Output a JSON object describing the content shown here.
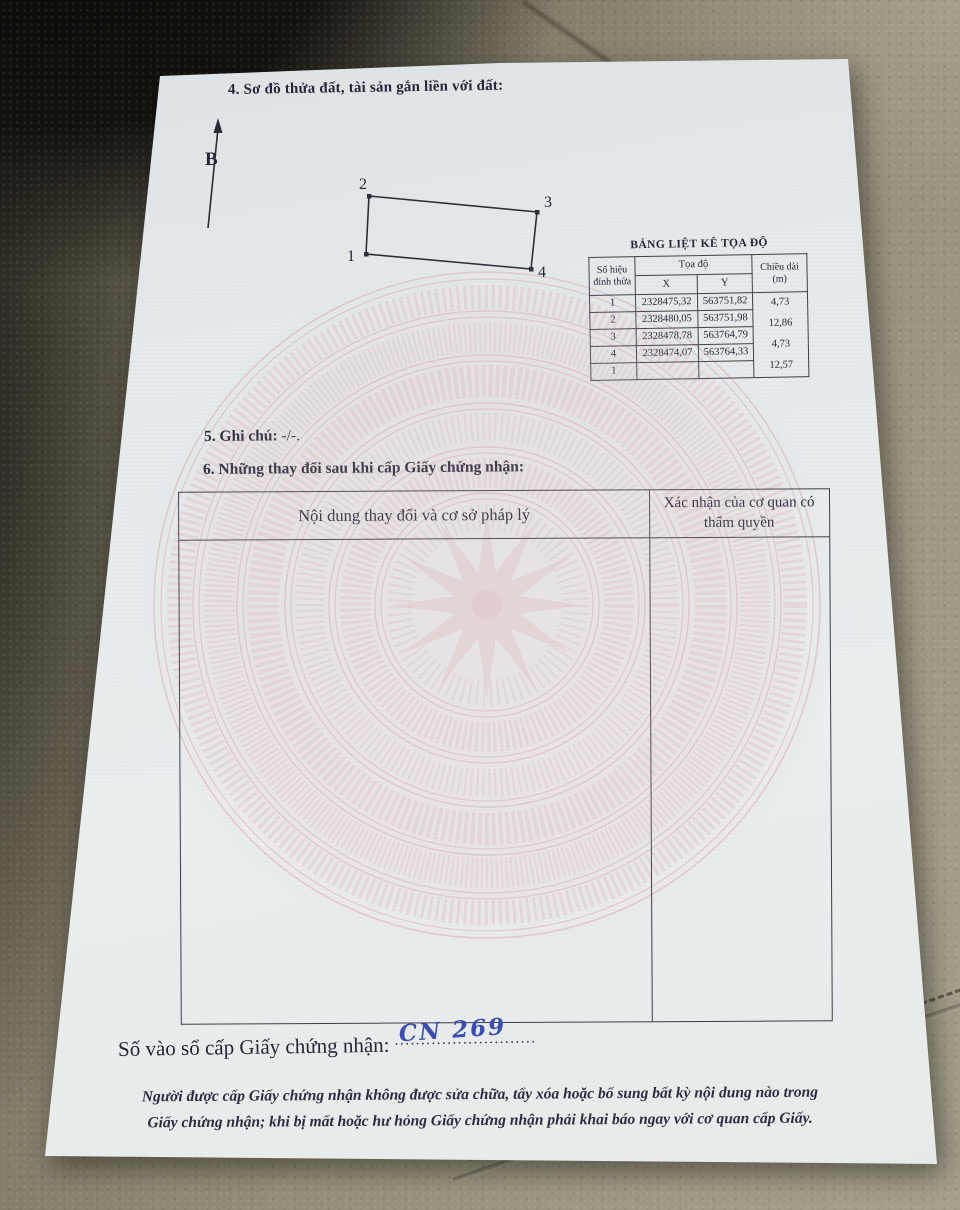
{
  "section4": {
    "heading": "4. Sơ đồ thửa đất, tài sản gắn liền với đất:"
  },
  "compass": {
    "label": "B"
  },
  "plot": {
    "vertices": [
      "1",
      "2",
      "3",
      "4"
    ]
  },
  "coord_table": {
    "title": "BẢNG LIỆT KÊ TỌA ĐỘ",
    "header": {
      "vertex": "Số hiệu đỉnh thửa",
      "coords": "Tọa độ",
      "x": "X",
      "y": "Y",
      "length": "Chiều dài (m)"
    },
    "rows": [
      {
        "id": "1",
        "x": "2328475,32",
        "y": "563751,82"
      },
      {
        "id": "2",
        "x": "2328480,05",
        "y": "563751,98"
      },
      {
        "id": "3",
        "x": "2328478,78",
        "y": "563764,79"
      },
      {
        "id": "4",
        "x": "2328474,07",
        "y": "563764,33"
      },
      {
        "id": "1",
        "x": "",
        "y": ""
      }
    ],
    "lengths": [
      "4,73",
      "12,86",
      "4,73",
      "12,57"
    ]
  },
  "section5": {
    "label": "5. Ghi chú:",
    "value": "-/-."
  },
  "section6": {
    "heading": "6. Những thay đổi sau khi cấp Giấy chứng nhận:",
    "col_left": "Nội dung thay đổi và cơ sở pháp lý",
    "col_right": "Xác nhận của cơ quan có thẩm quyền"
  },
  "registry": {
    "label": "Số vào sổ cấp Giấy chứng nhận:",
    "value": "CN 269",
    "leader": "..........................."
  },
  "footer": {
    "line1": "Người được cấp Giấy chứng nhận không được sửa chữa, tẩy xóa hoặc bổ sung bất kỳ nội dung nào trong",
    "line2": "Giấy chứng nhận; khi bị mất hoặc hư hỏng Giấy chứng nhận phải khai báo ngay với cơ quan cấp Giấy."
  },
  "colors": {
    "paper": "#e8edee",
    "pattern_pink": "#d9abb2",
    "ink": "#232738",
    "handwriting_blue": "#3a4cb5",
    "leather": "#98927d"
  }
}
